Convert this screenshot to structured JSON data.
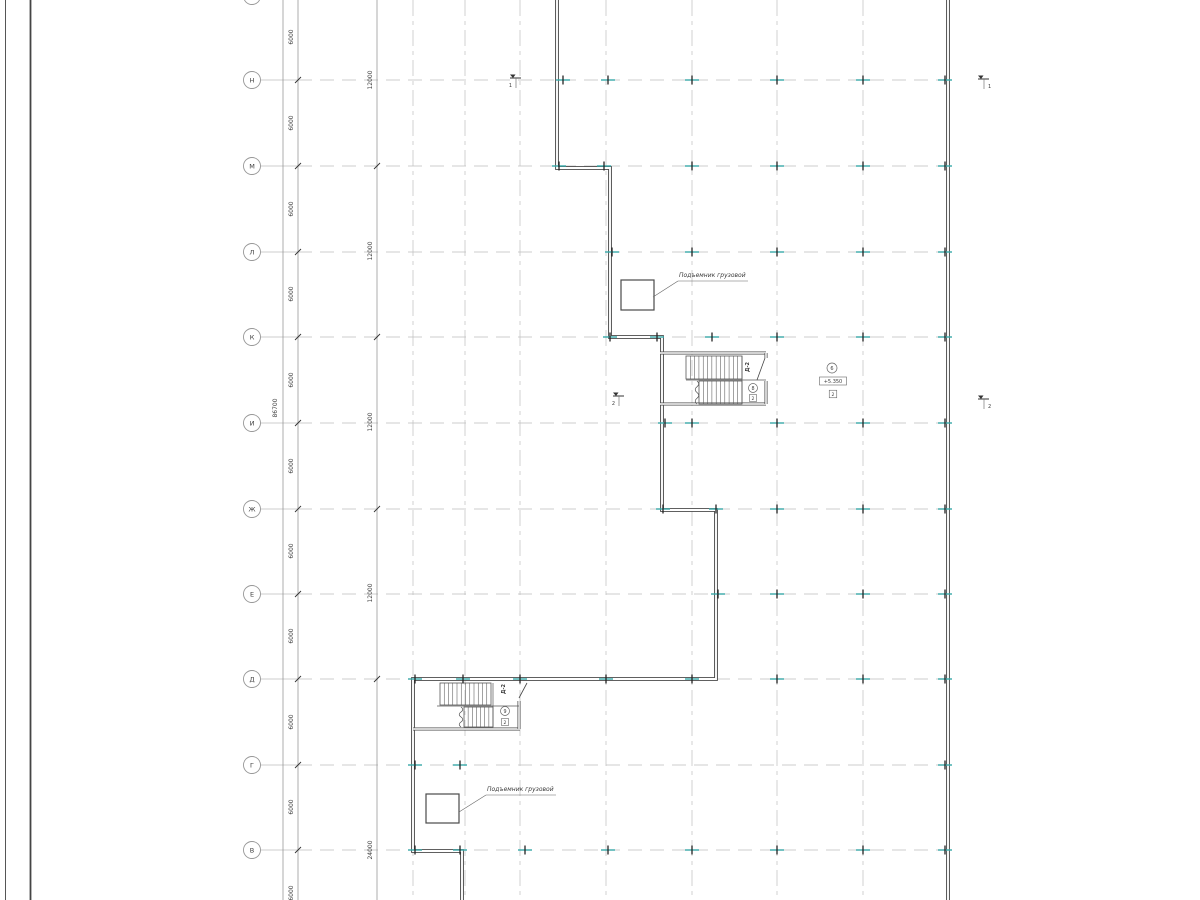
{
  "meta": {
    "title": "Architectural floor plan (CAD view)",
    "language": "ru"
  },
  "colors": {
    "background": "#ffffff",
    "wall": "#4a4a4a",
    "grid_row": "#bfbfbf",
    "grid_col": "#c6c6c6",
    "dim_line": "#8a8a8a",
    "text": "#3c3c3c",
    "accent_tick": "#38a9a9",
    "tick_black": "#222222",
    "bubble_stroke": "#979797",
    "stair": "#575757",
    "annot": "#5a5a5a",
    "frame": "#444444"
  },
  "frame": {
    "border_lines_x": [
      5.5,
      30.5
    ]
  },
  "grid": {
    "bubble_cx": 252,
    "bubble_r": 8.5,
    "row_leader_x1": 260,
    "row_chain_x": 298,
    "row_line_x2": 948,
    "rows": [
      {
        "label": "П",
        "y": -4
      },
      {
        "label": "Н",
        "y": 80
      },
      {
        "label": "М",
        "y": 166
      },
      {
        "label": "Л",
        "y": 252
      },
      {
        "label": "К",
        "y": 337
      },
      {
        "label": "И",
        "y": 423
      },
      {
        "label": "Ж",
        "y": 509
      },
      {
        "label": "Е",
        "y": 594
      },
      {
        "label": "Д",
        "y": 679
      },
      {
        "label": "Г",
        "y": 765
      },
      {
        "label": "В",
        "y": 850
      }
    ],
    "columns_x": [
      413,
      465,
      520,
      606,
      692,
      777,
      863
    ]
  },
  "dimensions": {
    "total_line_x": 283,
    "total_label": {
      "text": "86700",
      "x": 277,
      "y": 408
    },
    "chain6_x": 298,
    "chain6_labels": [
      {
        "text": "6000",
        "y": 37
      },
      {
        "text": "6000",
        "y": 123
      },
      {
        "text": "6000",
        "y": 209
      },
      {
        "text": "6000",
        "y": 294
      },
      {
        "text": "6000",
        "y": 380
      },
      {
        "text": "6000",
        "y": 466
      },
      {
        "text": "6000",
        "y": 551
      },
      {
        "text": "6000",
        "y": 636
      },
      {
        "text": "6000",
        "y": 722
      },
      {
        "text": "6000",
        "y": 807
      },
      {
        "text": "6000",
        "y": 893
      }
    ],
    "chain12_x": 377,
    "chain12_ticks_y": [
      166,
      337,
      509,
      679
    ],
    "chain12_labels": [
      {
        "text": "12000",
        "y": 80
      },
      {
        "text": "12000",
        "y": 251
      },
      {
        "text": "12000",
        "y": 422
      },
      {
        "text": "12000",
        "y": 593
      },
      {
        "text": "24000",
        "y": 850
      }
    ]
  },
  "walls": {
    "building": [
      [
        557,
        -2
      ],
      [
        557,
        168
      ],
      [
        610,
        168
      ],
      [
        610,
        337
      ],
      [
        662,
        337
      ],
      [
        662,
        510
      ],
      [
        716,
        510
      ],
      [
        716,
        679
      ],
      [
        413,
        679
      ],
      [
        413,
        851
      ],
      [
        462,
        851
      ],
      [
        462,
        902
      ]
    ],
    "right": [
      [
        948,
        -2
      ],
      [
        948,
        902
      ]
    ]
  },
  "ticks": [
    {
      "y": 80,
      "xs": [
        563,
        608,
        692,
        777,
        863,
        945
      ]
    },
    {
      "y": 166,
      "xs": [
        559,
        604,
        692,
        777,
        863,
        945
      ]
    },
    {
      "y": 252,
      "xs": [
        612,
        692,
        777,
        863,
        945
      ]
    },
    {
      "y": 337,
      "xs": [
        610,
        657,
        712,
        777,
        863,
        945
      ]
    },
    {
      "y": 423,
      "xs": [
        665,
        692,
        777,
        863,
        945
      ]
    },
    {
      "y": 509,
      "xs": [
        663,
        716,
        777,
        863,
        945
      ]
    },
    {
      "y": 594,
      "xs": [
        718,
        777,
        863,
        945
      ]
    },
    {
      "y": 679,
      "xs": [
        415,
        463,
        520,
        606,
        692,
        777,
        863,
        945
      ]
    },
    {
      "y": 765,
      "xs": [
        415,
        460,
        945
      ]
    },
    {
      "y": 850,
      "xs": [
        415,
        460,
        525,
        608,
        692,
        777,
        863,
        945
      ]
    }
  ],
  "stairs": [
    {
      "name": "stair-upper",
      "walls": [
        [
          [
            660,
            353
          ],
          [
            766,
            353
          ]
        ],
        [
          [
            660,
            404
          ],
          [
            766,
            404
          ]
        ],
        [
          [
            766,
            353
          ],
          [
            766,
            358
          ]
        ],
        [
          [
            766,
            381
          ],
          [
            766,
            404
          ]
        ]
      ],
      "door_leaf": [
        [
          765,
          358
        ],
        [
          757,
          380
        ]
      ],
      "separators": [
        [
          [
            686,
            380
          ],
          [
            766,
            380
          ]
        ],
        [
          [
            742,
            356
          ],
          [
            742,
            404
          ]
        ]
      ],
      "flights": [
        {
          "x1": 686,
          "y1": 356,
          "x2": 742,
          "y2": 379,
          "treads": 13
        },
        {
          "x1": 699,
          "y1": 381,
          "x2": 742,
          "y2": 404,
          "treads": 10
        }
      ],
      "breaks": [
        {
          "x": 697,
          "y1": 381,
          "y2": 404
        }
      ],
      "door_label": {
        "text": "Д-2",
        "x": 749,
        "y": 367
      },
      "circle_label": {
        "text": "8",
        "cx": 753,
        "cy": 388,
        "r": 4.5
      },
      "num_box": {
        "text": "2",
        "cx": 753,
        "cy": 398,
        "w": 7,
        "h": 7
      }
    },
    {
      "name": "stair-lower",
      "walls": [
        [
          [
            413,
            729
          ],
          [
            520,
            729
          ]
        ],
        [
          [
            519,
            701
          ],
          [
            519,
            729
          ]
        ]
      ],
      "door_leaf": [
        [
          519,
          698
        ],
        [
          527,
          683
        ]
      ],
      "separators": [
        [
          [
            437,
            706
          ],
          [
            519,
            706
          ]
        ],
        [
          [
            493,
            683
          ],
          [
            493,
            727
          ]
        ]
      ],
      "flights": [
        {
          "x1": 440,
          "y1": 683,
          "x2": 491,
          "y2": 705,
          "treads": 12
        },
        {
          "x1": 464,
          "y1": 707,
          "x2": 493,
          "y2": 727,
          "treads": 7
        }
      ],
      "breaks": [
        {
          "x": 461,
          "y1": 707,
          "y2": 727
        }
      ],
      "door_label": {
        "text": "Д-2",
        "x": 505,
        "y": 689
      },
      "circle_label": {
        "text": "9",
        "cx": 505,
        "cy": 711,
        "r": 4.5
      },
      "num_box": {
        "text": "2",
        "cx": 505,
        "cy": 722,
        "w": 7,
        "h": 7
      }
    }
  ],
  "lifts": [
    {
      "rect": [
        621,
        280,
        33,
        30
      ],
      "label": "Подъемник грузовой",
      "label_x": 679,
      "label_y": 277,
      "underline": [
        [
          678,
          281
        ],
        [
          748,
          281
        ]
      ],
      "leader": [
        [
          653,
          297
        ],
        [
          678,
          281
        ]
      ]
    },
    {
      "rect": [
        426,
        794,
        33,
        29
      ],
      "label": "Подъемник грузовой",
      "label_x": 487,
      "label_y": 791,
      "underline": [
        [
          486,
          795
        ],
        [
          556,
          795
        ]
      ],
      "leader": [
        [
          459,
          812
        ],
        [
          486,
          795
        ]
      ]
    }
  ],
  "level_mark": {
    "circle": {
      "text": "6",
      "cx": 832,
      "cy": 368,
      "r": 5
    },
    "value_box": {
      "text": "+5.350",
      "cx": 833,
      "cy": 381,
      "w": 27,
      "h": 8
    },
    "num_box": {
      "text": "2",
      "cx": 833,
      "cy": 394,
      "w": 7.5,
      "h": 7.5
    }
  },
  "section_markers": [
    {
      "num": "1",
      "x": 516,
      "y": 78,
      "num_side": "left"
    },
    {
      "num": "1",
      "x": 984,
      "y": 79,
      "num_side": "right"
    },
    {
      "num": "2",
      "x": 619,
      "y": 396,
      "num_side": "left"
    },
    {
      "num": "2",
      "x": 984,
      "y": 399,
      "num_side": "right"
    }
  ]
}
